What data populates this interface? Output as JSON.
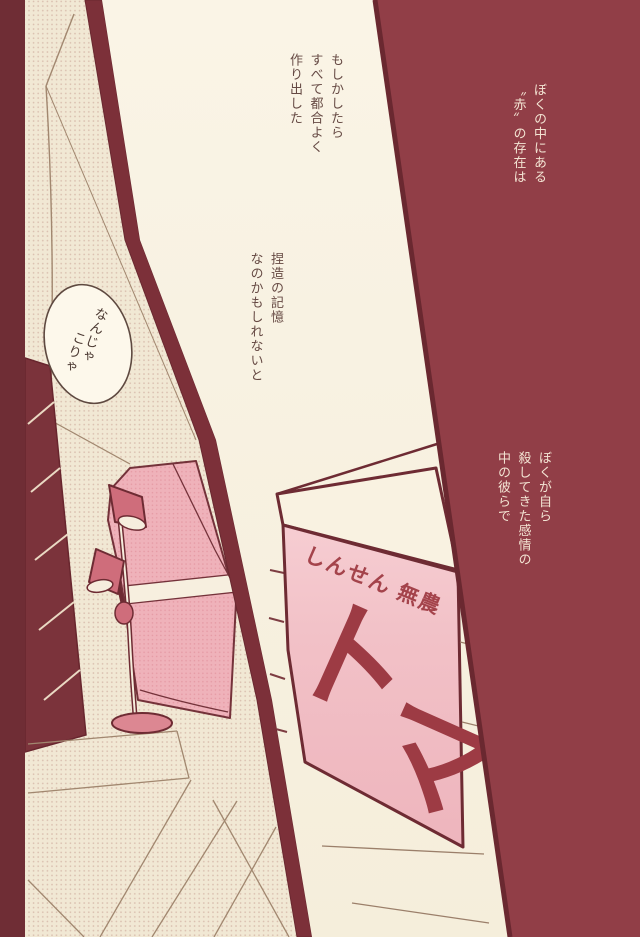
{
  "narration": {
    "block1": {
      "lines": [
        "もしかしたら",
        "すべて都合よく",
        "作り出した"
      ]
    },
    "block2": {
      "lines": [
        "捏造の記憶",
        "なのかもしれないと"
      ]
    },
    "block3": {
      "lines": [
        "ぼくの中にある",
        "〝赤〟の存在は"
      ]
    },
    "block4": {
      "lines": [
        "ぼくが自ら",
        "殺してきた感情の",
        "中の彼らで"
      ]
    }
  },
  "speech_bubble": {
    "lines": [
      "なんじゃ",
      "こりゃ"
    ]
  },
  "box": {
    "label": "しんせん 無農",
    "big_text_chars": [
      "ト",
      "マ"
    ]
  },
  "colors": {
    "background_maroon": "#913e47",
    "gutter_maroon": "#7c3039",
    "panel_cream": "#f8f1e0",
    "sofa_pink": "#efb2ba",
    "lamp_rose": "#cf6d7b",
    "box_pink": "#f2c1c7",
    "box_letter_red": "#9d3b44",
    "narration_ink": "#664a44",
    "narration_cream": "#f3e4d3"
  }
}
